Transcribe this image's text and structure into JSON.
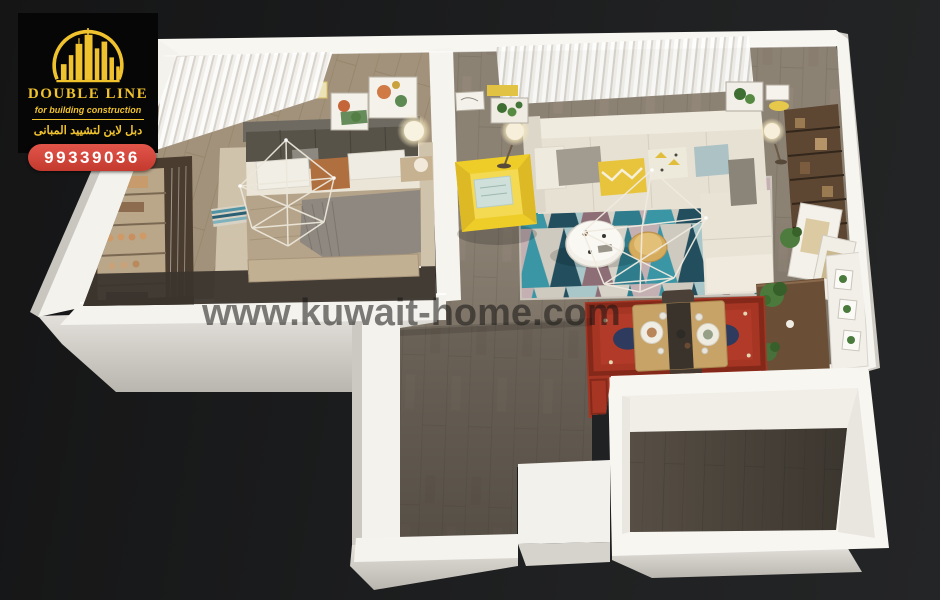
{
  "window": {
    "width": 940,
    "height": 600,
    "kind": "3d-floor-plan-render"
  },
  "logo": {
    "title": "DOUBLE LINE",
    "subtitle": "for building construction",
    "subtitle_arabic": "دبل لاين لتشييد المبانى",
    "phone": "99339036"
  },
  "watermark": {
    "text": "www.kuwait-home.com"
  },
  "palette": {
    "background": "#1d1e20",
    "brand_yellow": "#f0c32e",
    "phone_pill_red": "#d0453a",
    "wall_white": "#f6f4ef",
    "wood_floor": "#8b8173",
    "wood_floor_dark": "#574f45",
    "bedroom_floor": "#a2927b",
    "rug_teal": "#3a95a4",
    "rug_navy": "#224e5e",
    "rug_mauve": "#8d6e76",
    "sofa_cream": "#e9e3d6",
    "armchair_yellow": "#eecd29",
    "dining_rug_red": "#a63524",
    "shelf_wood": "#5d4632"
  },
  "scene": {
    "rooms": [
      "bedroom",
      "living-room",
      "dining-area",
      "hallway",
      "kitchen"
    ]
  }
}
